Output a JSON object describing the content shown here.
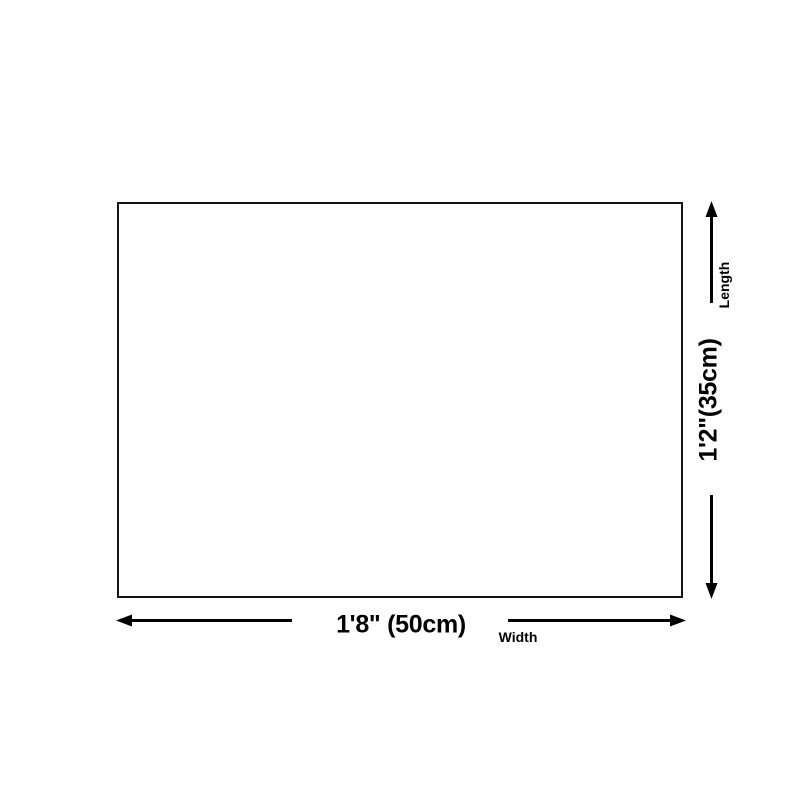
{
  "diagram": {
    "length": {
      "value": "1'2\"(35cm)",
      "label": "Length"
    },
    "width": {
      "value": "1'8\" (50cm)",
      "label": "Width"
    }
  },
  "colors": {
    "background": "#ffffff",
    "line": "#000000",
    "border": "#141414",
    "text": "#000000"
  }
}
